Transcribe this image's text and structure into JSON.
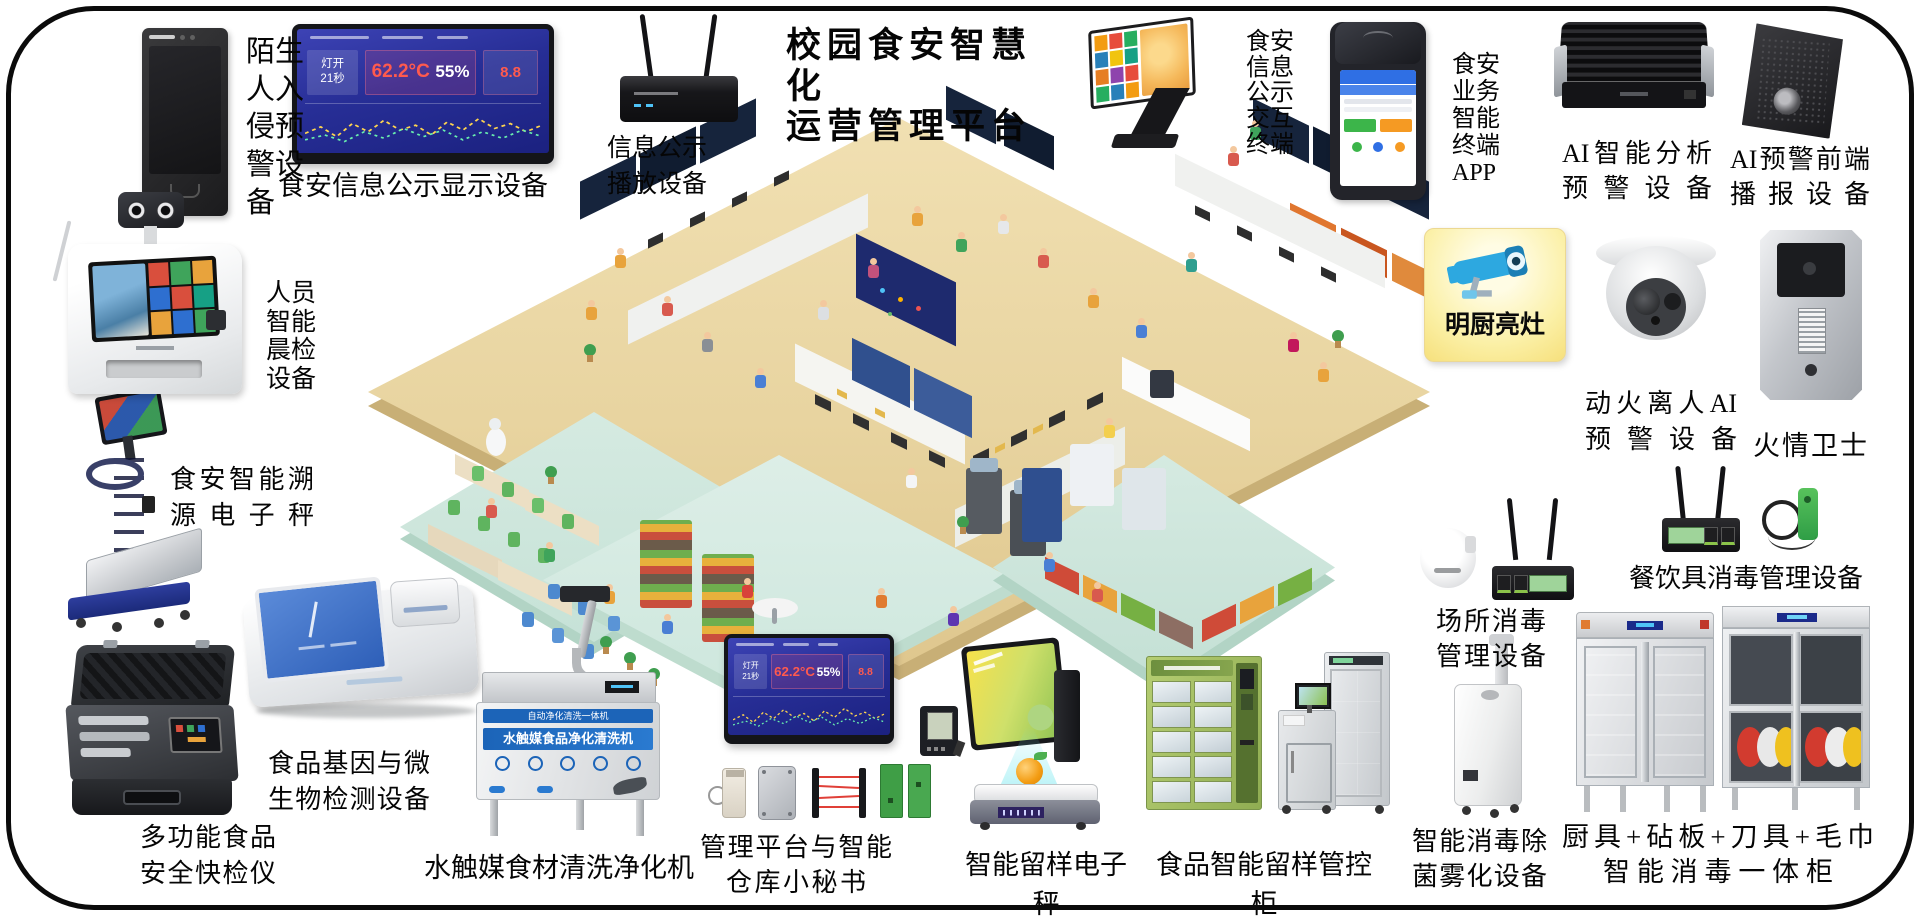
{
  "title": {
    "line1": "校园食安智慧化",
    "line2": "运营管理平台"
  },
  "labels": {
    "stranger": "陌生人入侵预警设备",
    "display_board": "食安信息公示显示设备",
    "broadcast": {
      "l1": "信息公示",
      "l2": "播放设备"
    },
    "kiosk": "食安信息公示交互终端",
    "pos_app": "食安业务智能终端APP",
    "ai_analysis": {
      "l1": "AI智能分析",
      "l2": "预警设备"
    },
    "ai_broadcast": {
      "l1": "AI预警前端",
      "l2": "播报设备"
    },
    "bright_kitchen": "明厨亮灶",
    "fire_ai": {
      "l1": "动火离人AI",
      "l2": "预警设备"
    },
    "fire_guard": "火情卫士",
    "tableware": "餐饮具消毒管理设备",
    "place_disinfect": {
      "l1": "场所消毒",
      "l2": "管理设备"
    },
    "morning_check": "人员智能晨检设备",
    "trace_scale": {
      "l1": "食安智能溯",
      "l2": "源电子秤"
    },
    "quick_test": {
      "l1": "多功能食品",
      "l2": "安全快检仪"
    },
    "gene_test": {
      "l1": "食品基因与微",
      "l2": "生物检测设备"
    },
    "washer": "水触媒食材清洗净化机",
    "mgmt": {
      "l1": "管理平台与智能",
      "l2": "仓库小秘书"
    },
    "sample_scale": "智能留样电子秤",
    "sample_cabinet": "食品智能留样管控柜",
    "fog": {
      "l1": "智能消毒除",
      "l2": "菌雾化设备"
    },
    "cabinet": {
      "l1": "厨具+砧板+刀具+毛巾",
      "l2": "智能消毒一体柜"
    }
  },
  "dashboard": {
    "lamp_label": "灯开",
    "lamp_value": "21秒",
    "temp": "62.2°C",
    "humidity": "55%",
    "alert": "8.8"
  },
  "washer": {
    "strip": "自动净化清洗一体机",
    "banner": "水触媒食品净化清洗机"
  },
  "colors": {
    "dashboard_bg": "#272e96",
    "alert_red": "#ff5a4e",
    "brand_blue": "#1c64b8",
    "bright_card_yellow": "#fbefa2",
    "locker_green": "#a2bd62",
    "floor_tan": "#e8d4a0",
    "platform_mint": "#cde7dd"
  }
}
